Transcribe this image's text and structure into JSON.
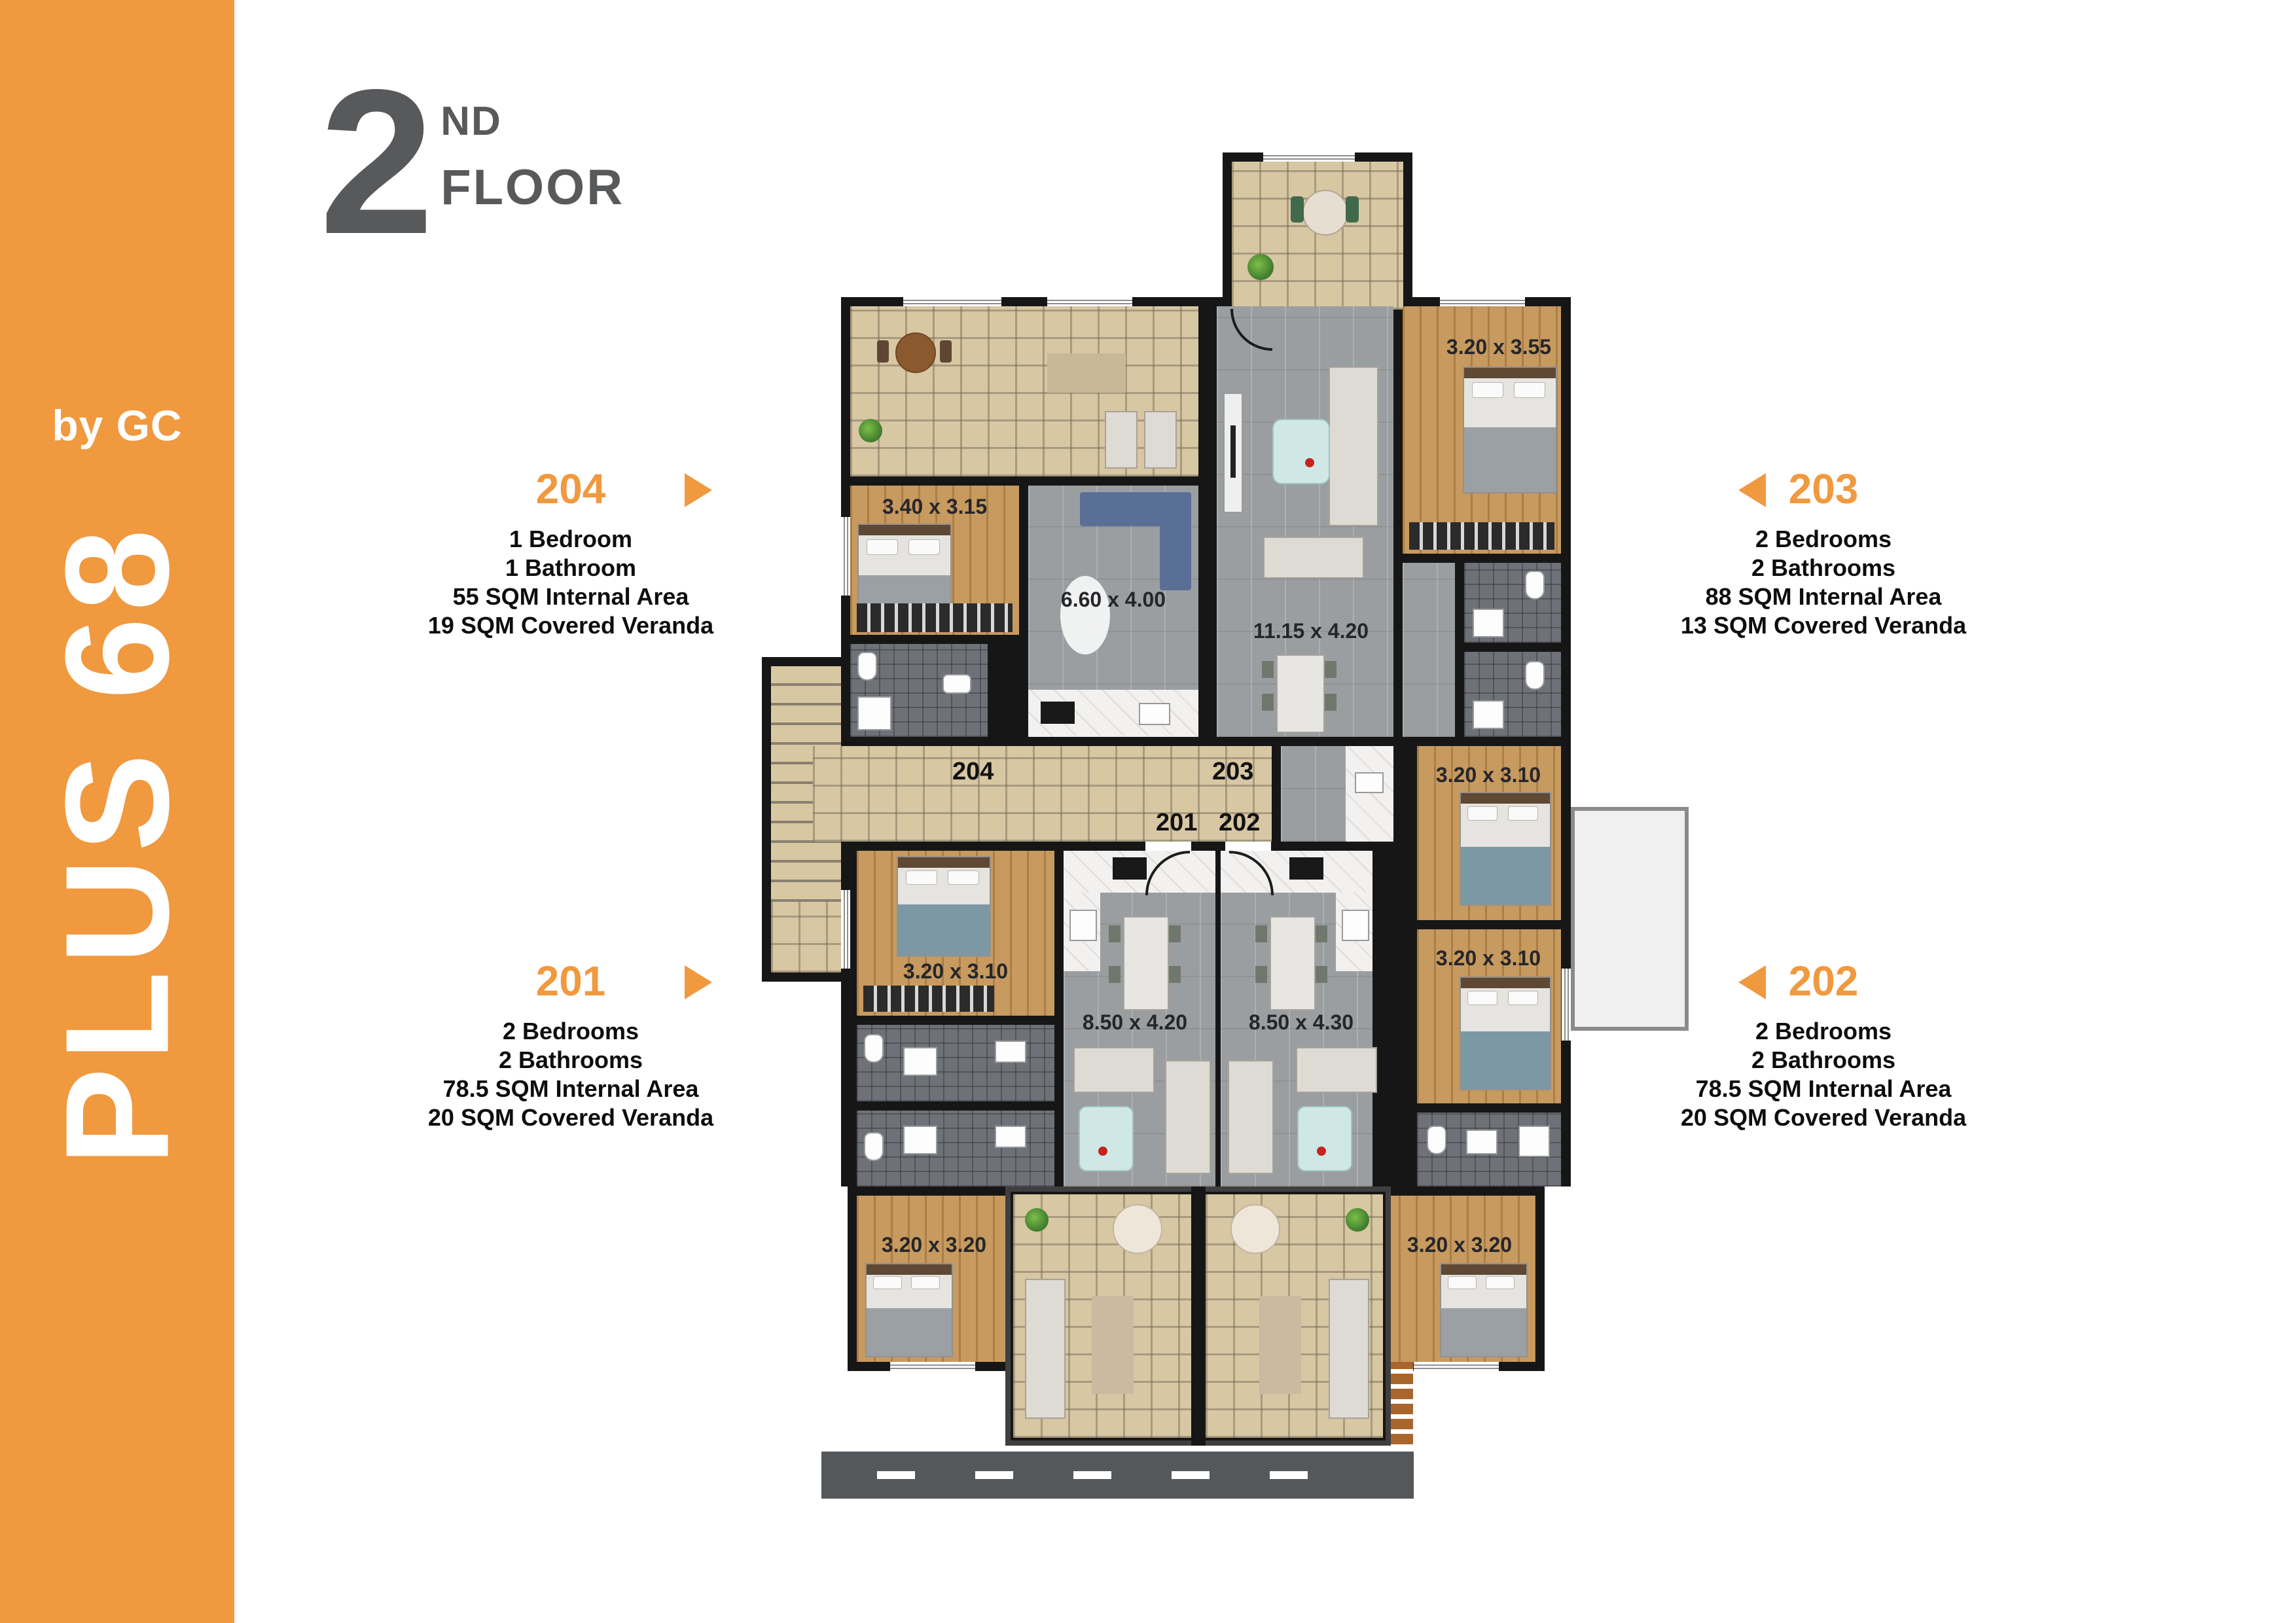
{
  "brand": {
    "sub": "by GC",
    "main": "PLUS 68"
  },
  "title": {
    "number": "2",
    "ordinal": "ND",
    "word": "FLOOR"
  },
  "units": [
    {
      "number": "204",
      "arrow": "right",
      "details": [
        "1 Bedroom",
        "1 Bathroom",
        "55 SQM Internal Area",
        "19 SQM Covered Veranda"
      ]
    },
    {
      "number": "203",
      "arrow": "left",
      "details": [
        "2 Bedrooms",
        "2 Bathrooms",
        "88 SQM Internal Area",
        "13 SQM Covered Veranda"
      ]
    },
    {
      "number": "201",
      "arrow": "right",
      "details": [
        "2 Bedrooms",
        "2 Bathrooms",
        "78.5 SQM Internal Area",
        "20 SQM Covered Veranda"
      ]
    },
    {
      "number": "202",
      "arrow": "left",
      "details": [
        "2 Bedrooms",
        "2 Bathrooms",
        "78.5 SQM Internal Area",
        "20 SQM Covered Veranda"
      ]
    }
  ],
  "plan": {
    "hall_labels": [
      "204",
      "203",
      "201",
      "202"
    ],
    "room_dims": [
      "3.40 x 3.15",
      "3.20 x 3.55",
      "6.60 x 4.00",
      "11.15 x 4.20",
      "3.20 x 3.10",
      "3.20 x 3.10",
      "3.20 x 3.10",
      "8.50 x 4.20",
      "8.50 x 4.30",
      "3.20 x 3.20",
      "3.20 x 3.20"
    ]
  },
  "colors": {
    "accent": "#F0993F",
    "heading": "#58595B",
    "wall": "#161616",
    "beige_tile": "#D8C7A3",
    "gray_tile": "#9B9EA1",
    "dark_tile": "#6E7278",
    "wood": "#C79A5F",
    "marble": "#F2F1EF",
    "road": "#55585A",
    "blue_sofa": "#5A6F96"
  }
}
